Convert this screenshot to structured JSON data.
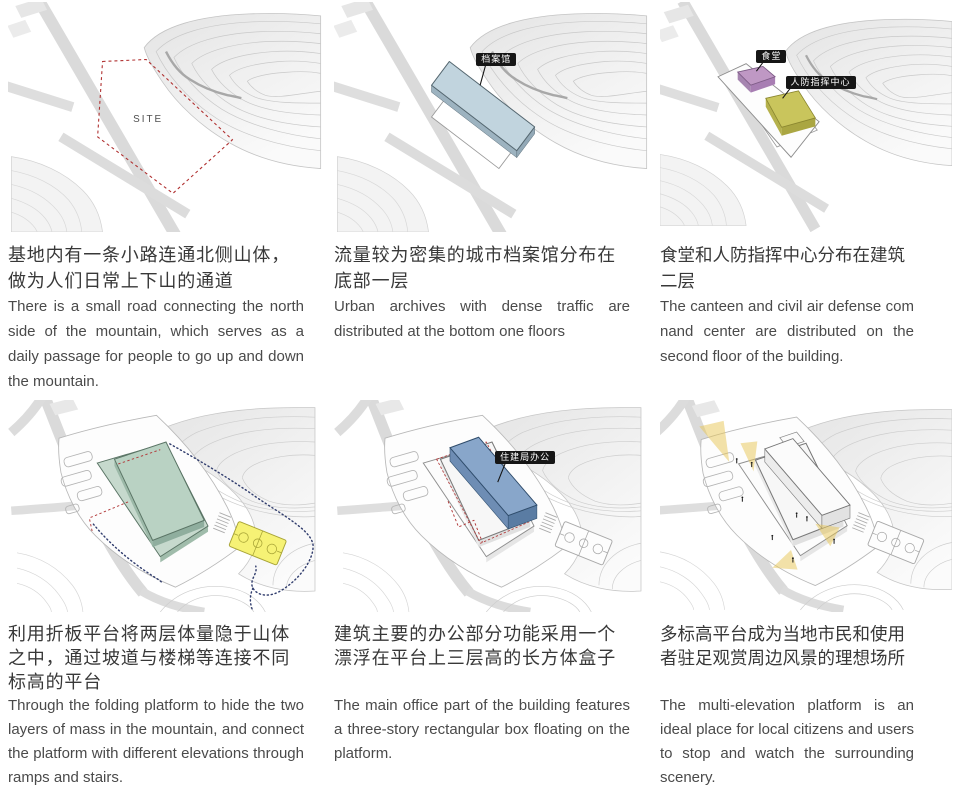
{
  "panels": [
    {
      "site_label": "SITE",
      "zh": "基地内有一条小路连通北侧山体，做为人们日常上下山的通道",
      "en": "There is a small road connecting the north side of the mountain, which serves as a daily passage for people to go up and down the mountain."
    },
    {
      "tag": "档案馆",
      "zh": "流量较为密集的城市档案馆分布在底部一层",
      "en": "Urban archives with dense traffic are distributed at the bottom one floors"
    },
    {
      "tag_canteen": "食堂",
      "tag_defense": "人防指挥中心",
      "zh": "食堂和人防指挥中心分布在建筑二层",
      "en": "The canteen and civil air defense com nand center are distributed on the second floor of the building."
    },
    {
      "zh": "利用折板平台将两层体量隐于山体之中，通过坡道与楼梯等连接不同标高的平台",
      "en": "Through the folding platform to hide the two layers of mass in the mountain, and connect the platform with different elevations through ramps and stairs."
    },
    {
      "tag": "住建局办公",
      "zh": "建筑主要的办公部分功能采用一个漂浮在平台上三层高的长方体盒子",
      "en": "The main office part of the building features a three-story rectangular box floating on the platform."
    },
    {
      "zh": "多标高平台成为当地市民和使用者驻足观赏周边风景的理想场所",
      "en": "The multi-elevation platform is an ideal place for local citizens and users to stop and watch the surrounding scenery."
    }
  ],
  "colors": {
    "site_outline_red": "#b03030",
    "archives_blue": "#c1d4de",
    "canteen_purple": "#bf98c4",
    "defense_yellow": "#c9c55c",
    "platform_green": "#c6d9cd",
    "office_blue": "#88a6ca",
    "court_yellow": "#f6f275",
    "beam_yellow": "#e7c654"
  }
}
